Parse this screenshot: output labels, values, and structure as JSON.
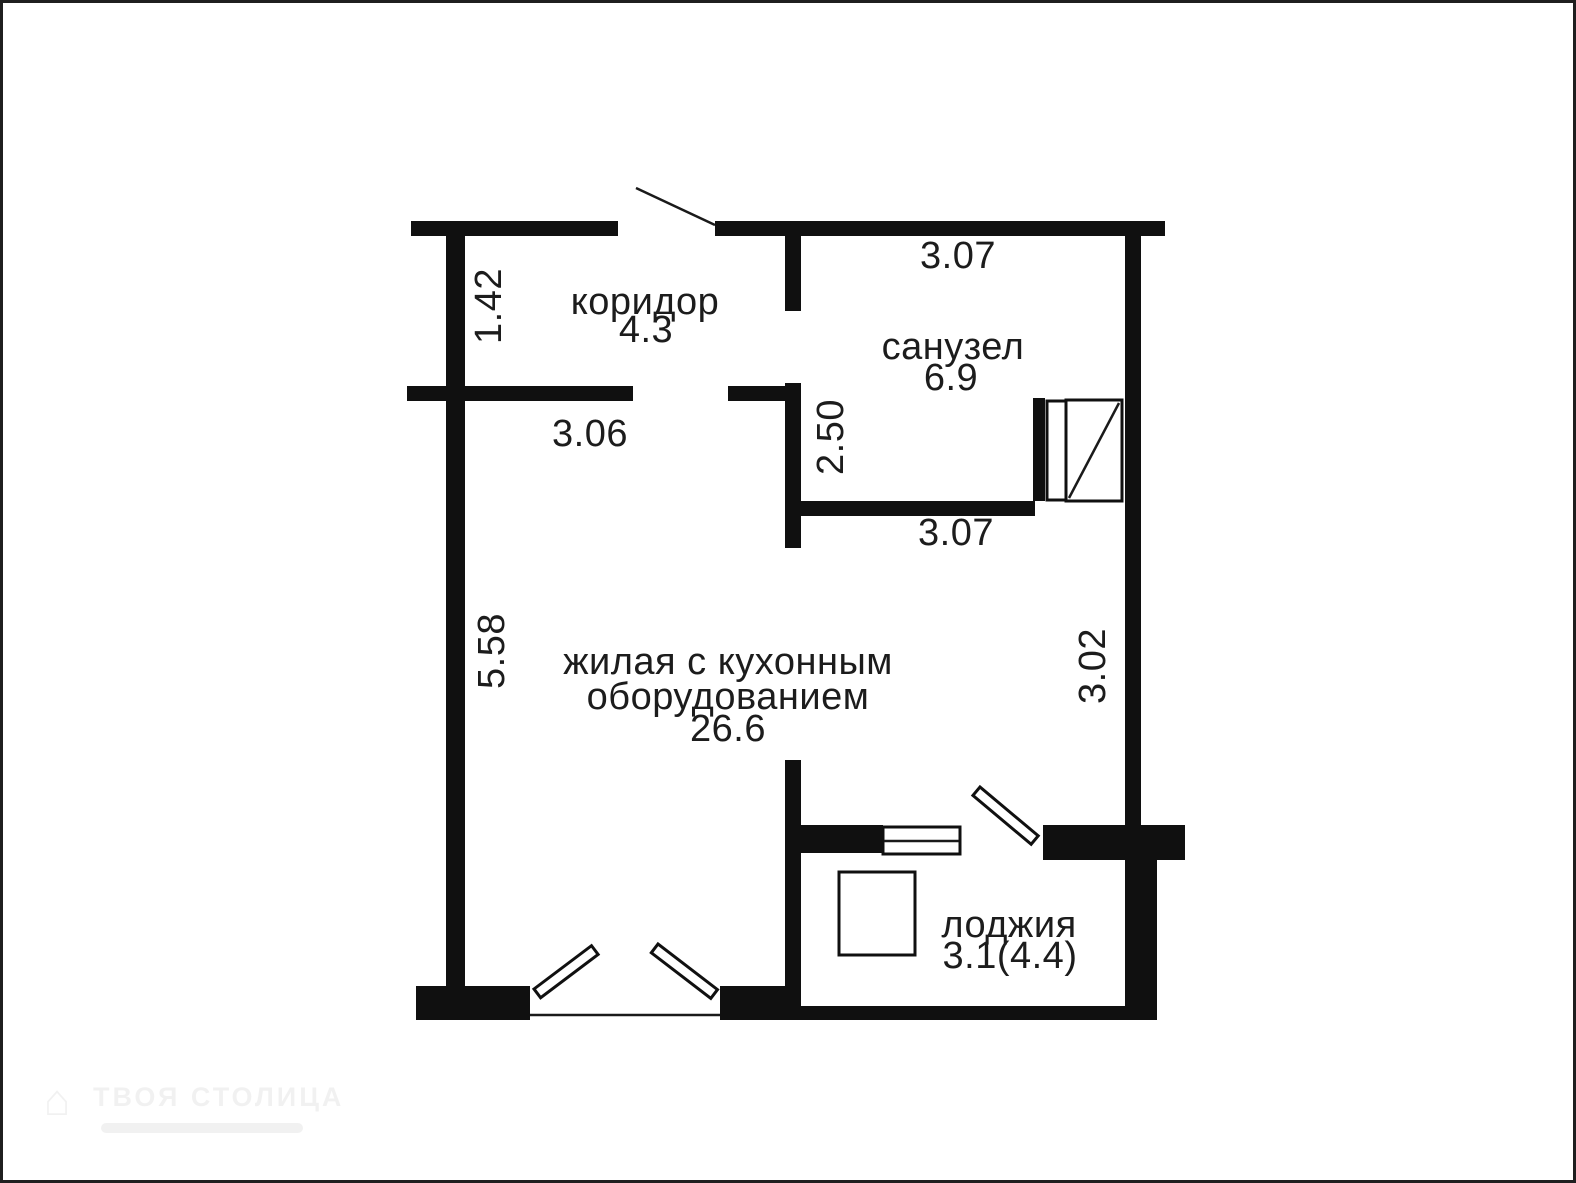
{
  "plan": {
    "type": "apartment-floor-plan",
    "rooms": [
      {
        "id": "corridor",
        "name": "коридор",
        "area": "4.3"
      },
      {
        "id": "bathroom",
        "name": "санузел",
        "area": "6.9"
      },
      {
        "id": "living",
        "name": "жилая с кухонным",
        "name_line2": "оборудованием",
        "area": "26.6"
      },
      {
        "id": "loggia",
        "name": "лоджия",
        "area": "3.1(4.4)"
      }
    ],
    "dimensions": [
      {
        "id": "bathroom-top-width",
        "value": "3.07",
        "orientation": "horizontal"
      },
      {
        "id": "corridor-left-height",
        "value": "1.42",
        "orientation": "vertical"
      },
      {
        "id": "corridor-bottom-width",
        "value": "3.06",
        "orientation": "horizontal"
      },
      {
        "id": "bathroom-wall-height",
        "value": "2.50",
        "orientation": "vertical"
      },
      {
        "id": "bathroom-bottom-width",
        "value": "3.07",
        "orientation": "horizontal"
      },
      {
        "id": "living-left-height",
        "value": "5.58",
        "orientation": "vertical"
      },
      {
        "id": "living-right-height",
        "value": "3.02",
        "orientation": "vertical"
      }
    ],
    "symbols": [
      "entry-door-swing-line",
      "shower-cabin",
      "loggia-window",
      "balcony-door-leaf",
      "window-sash-left",
      "window-sash-right",
      "loggia-cabinet"
    ],
    "watermark": {
      "agency": "ТВОЯ СТОЛИЦА",
      "logo_icon": "house-icon"
    },
    "colors": {
      "wall": "#101010",
      "text": "#1c1c1c",
      "background": "#ffffff"
    }
  }
}
